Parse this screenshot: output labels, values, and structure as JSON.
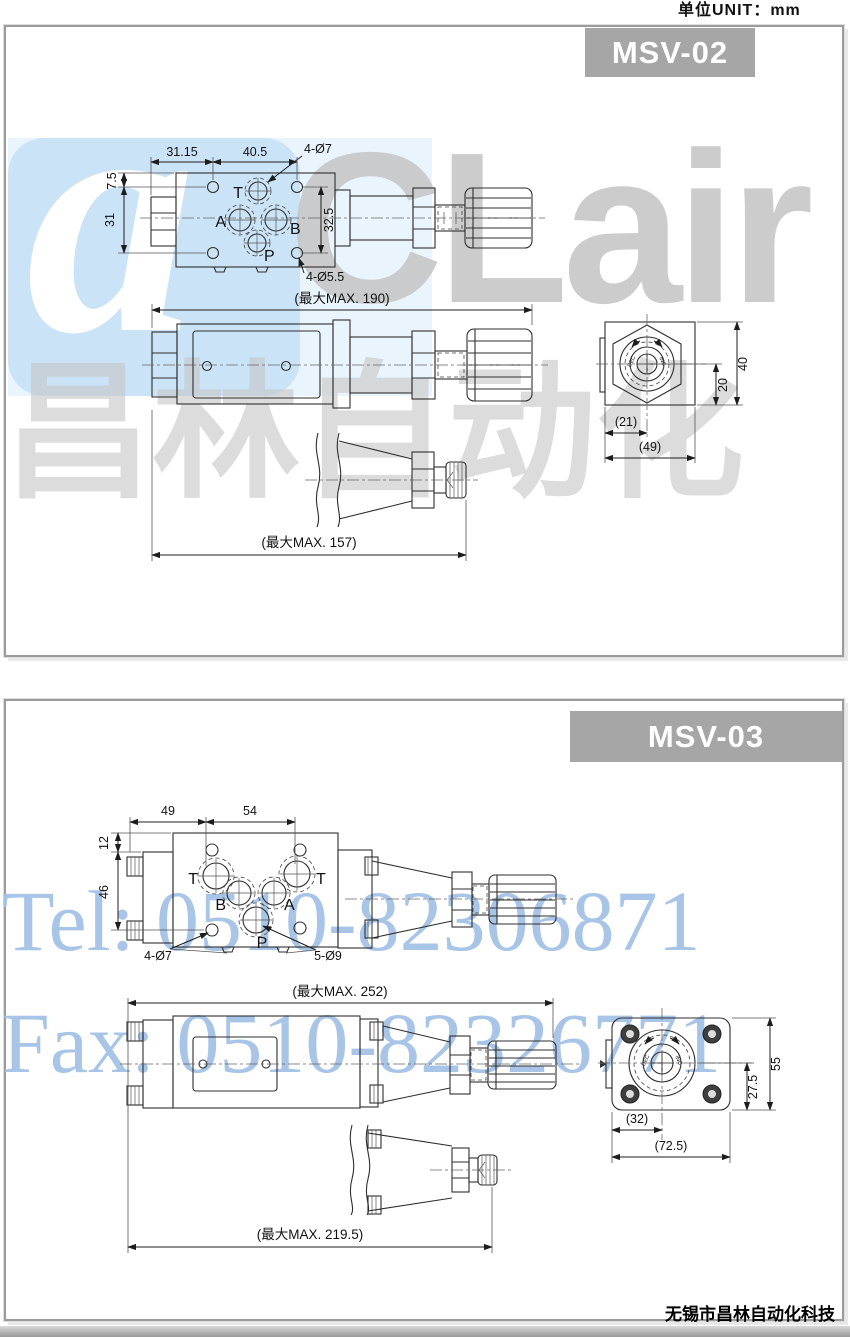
{
  "page": {
    "unit_label": "单位UNIT：mm",
    "company_footer": "无锡市昌林自动化科技"
  },
  "watermark": {
    "logo_letter": "a",
    "brand": "CLair",
    "brand_cjk": "昌林自动化",
    "tel": "Tel: 0510-82306871",
    "fax": "Fax: 0510-82326771",
    "colors": {
      "logo_bg": "#cbe3f7",
      "brand_gray": "#c4c4c4",
      "contact_blue": "#a4c1e6",
      "badge_gray": "#a6a6a6"
    }
  },
  "msv02": {
    "model": "MSV-02",
    "plan_view": {
      "dim_width_left": "31.15",
      "dim_width_right": "40.5",
      "holes_top_label": "4-Ø7",
      "dim_edge_top": "7.5",
      "dim_height_left": "31",
      "dim_ports_vertical": "32.5",
      "holes_bottom_label": "4-Ø5.5",
      "ports": {
        "t": "T",
        "a": "A",
        "b": "B",
        "p": "P"
      }
    },
    "side_view": {
      "overall_length": "(最大MAX. 190)"
    },
    "knob_view": {
      "overall_length": "(最大MAX. 157)"
    },
    "end_view": {
      "dim_height": "40",
      "dim_center": "20",
      "dim_offset": "(21)",
      "dim_width": "(49)",
      "knob_dec": "DEC",
      "knob_inc": "INC"
    }
  },
  "msv03": {
    "model": "MSV-03",
    "plan_view": {
      "dim_width_left": "49",
      "dim_width_right": "54",
      "dim_edge_top": "12",
      "dim_height_left": "46",
      "holes_bolt_label": "4-Ø7",
      "holes_port_label": "5-Ø9",
      "ports": {
        "t_left": "T",
        "b": "B",
        "a": "A",
        "t_right": "T",
        "p": "P"
      }
    },
    "side_view": {
      "overall_length": "(最大MAX. 252)"
    },
    "knob_view": {
      "overall_length": "(最大MAX. 219.5)"
    },
    "end_view": {
      "dim_height": "55",
      "dim_center": "27.5",
      "dim_offset": "(32)",
      "dim_width": "(72.5)",
      "knob_dec": "DEC",
      "knob_inc": "INC"
    }
  }
}
